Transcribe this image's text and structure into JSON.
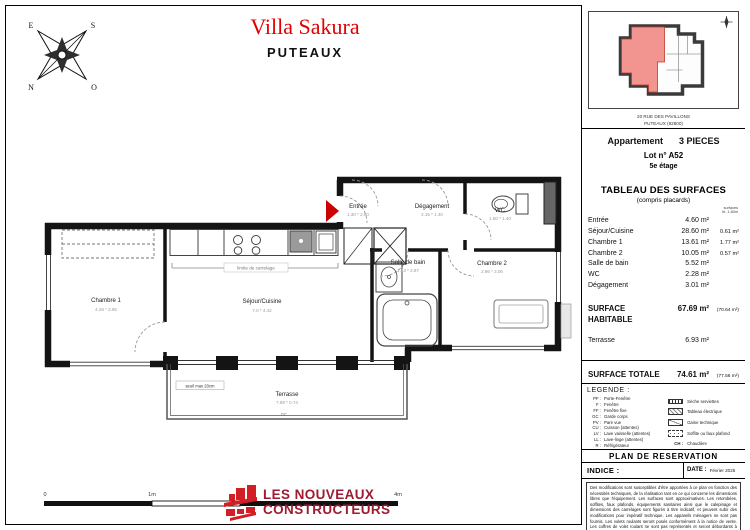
{
  "header": {
    "project": "Villa Sakura",
    "city": "PUTEAUX"
  },
  "compass": {
    "n": "N",
    "s": "S",
    "e": "E",
    "o": "O"
  },
  "sidebar": {
    "key_plan": {
      "address_line1": "20 RUE DES PAVILLONS",
      "address_line2": "PUTEAUX (92800)"
    },
    "apartment": {
      "label": "Appartement",
      "type": "3 PIECES",
      "lot": "Lot n° A52",
      "floor": "5e étage"
    },
    "surfaces": {
      "title": "TABLEAU DES SURFACES",
      "subtitle": "(compris placards)",
      "col_note_line1": "surfaces",
      "col_note_line2": "ht. 1.80m",
      "rows": [
        {
          "label": "Entrée",
          "value": "4.60 m²",
          "extra": ""
        },
        {
          "label": "Séjour/Cuisine",
          "value": "28.60 m²",
          "extra": "0.61 m²"
        },
        {
          "label": "Chambre 1",
          "value": "13.61 m²",
          "extra": "1.77 m²"
        },
        {
          "label": "Chambre 2",
          "value": "10.05 m²",
          "extra": "0.57 m²"
        },
        {
          "label": "Salle de bain",
          "value": "5.52 m²",
          "extra": ""
        },
        {
          "label": "WC",
          "value": "2.28 m²",
          "extra": ""
        },
        {
          "label": "Dégagement",
          "value": "3.01 m²",
          "extra": ""
        }
      ],
      "habitable": {
        "label": "SURFACE HABITABLE",
        "value": "67.69 m²",
        "note": "(70.64 m²)"
      },
      "terrace": {
        "label": "Terrasse",
        "value": "6.93 m²"
      },
      "total": {
        "label": "SURFACE TOTALE",
        "value": "74.61 m²",
        "note": "(77.56 m²)"
      }
    },
    "legend": {
      "title": "LEGENDE :",
      "abbreviations": [
        {
          "abbr": "PF :",
          "label": "Porte-Fenêtre"
        },
        {
          "abbr": "F :",
          "label": "Fenêtre"
        },
        {
          "abbr": "FF :",
          "label": "Fenêtre fixe"
        },
        {
          "abbr": "GC :",
          "label": "Garde corps"
        },
        {
          "abbr": "PV :",
          "label": "Pare vue"
        },
        {
          "abbr": "CU :",
          "label": "Cuisson (attentes)"
        },
        {
          "abbr": "LV :",
          "label": "Lave vaisselle (attentes)"
        },
        {
          "abbr": "LL :",
          "label": "Lave-linge (attentes)"
        },
        {
          "abbr": "R :",
          "label": "Réfrigérateur"
        }
      ],
      "symbols": [
        {
          "label": "Sèche serviettes"
        },
        {
          "label": "Tableau électrique"
        },
        {
          "label": "Gaine technique"
        },
        {
          "label": "Soffite ou faux plafond"
        },
        {
          "abbr": "CH :",
          "label": "Chaudière"
        }
      ]
    },
    "reservation": {
      "title": "PLAN DE  RESERVATION",
      "indice_label": "INDICE :",
      "date_label": "DATE :",
      "date_value": "Février 2025",
      "disclaimer": "Des modifications sont susceptibles d'être apportées à ce plan en fonction des nécessités techniques, de la réalisation tant en ce qui concerne les dimensions libres que l'équipement. Les surfaces sont approximatives. Les retombées, soffites, faux plafonds, équipements sanitaires ainsi que le calepinage et dimensions des carrelages sont figurés à titre indicatif, et peuvent subir des modifications pour impératif technique. Les appareils ménagers ne sont pas fournis. Les volets roulants seront posés conformément à la notice de vente. Les coffres de volet roulant ne sont pas représentés et seront débordants à l'intérieur. La hauteur des seuils au droit des portes-fenêtres sur balcons ou terrasses pourra varier de 5 à 20 cm à partir du sol intérieur. La hauteur entre le jardin et la terrasse pourra varier entre 0 et 60 cm. Les jardins ne seront pas nivelés, seront livrés bruts et pourront comporter des talus et des pentes."
    }
  },
  "plan": {
    "rooms": [
      {
        "name": "Entrée",
        "dims": "1.30 * 2.50"
      },
      {
        "name": "Dégagement",
        "dims": "2.15 * 1.40"
      },
      {
        "name": "WC",
        "dims": "1.60 * 1.40"
      },
      {
        "name": "Salle de bain",
        "dims": "2.13 * 2.87"
      },
      {
        "name": "Chambre 2",
        "dims": "2.96 * 3.06"
      },
      {
        "name": "Chambre 1",
        "dims": "4.28 * 2.95"
      },
      {
        "name": "Séjour/Cuisine",
        "dims": "7.0 * 4.42"
      },
      {
        "name": "Terrasse",
        "dims": "7.58 * 0.74"
      }
    ],
    "notes": {
      "carrelage": "limite de carrelage",
      "seuil": "seuil max 20cm",
      "gc": "GC"
    }
  },
  "scalebar": {
    "t0": "0",
    "t1": "1m",
    "t2": "2m",
    "t4": "4m"
  },
  "logo": {
    "line1": "LES NOUVEAUX",
    "line2": "CONSTRUCTEURS"
  },
  "colors": {
    "title_red": "#e10000",
    "plan_red": "#cc0000",
    "highlight": "#f2948f",
    "logo_red": "#d21f26",
    "logo_text": "#9e1b32"
  }
}
